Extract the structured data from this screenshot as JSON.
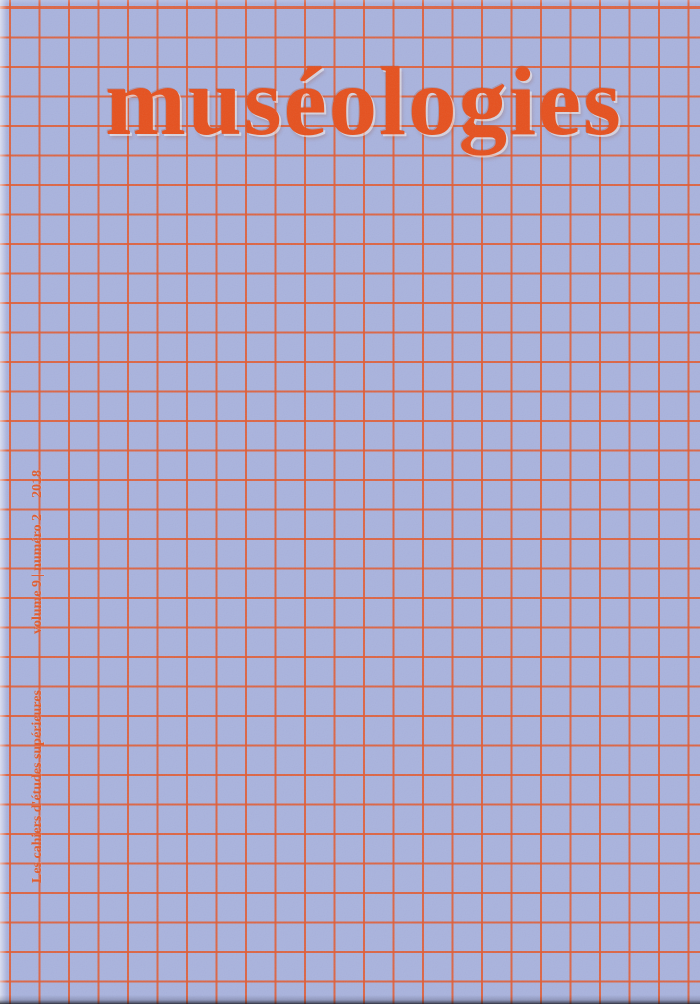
{
  "cover": {
    "title": "muséologies",
    "series": "Les cahiers d'études supérieures",
    "volume": "volume 9",
    "separator": "|",
    "issue": "numéro 2",
    "year": "2018",
    "colors": {
      "background": "#a9b3de",
      "grid_line": "#e25a30",
      "title_text": "#e6501d",
      "side_text": "#e15a2c"
    }
  }
}
